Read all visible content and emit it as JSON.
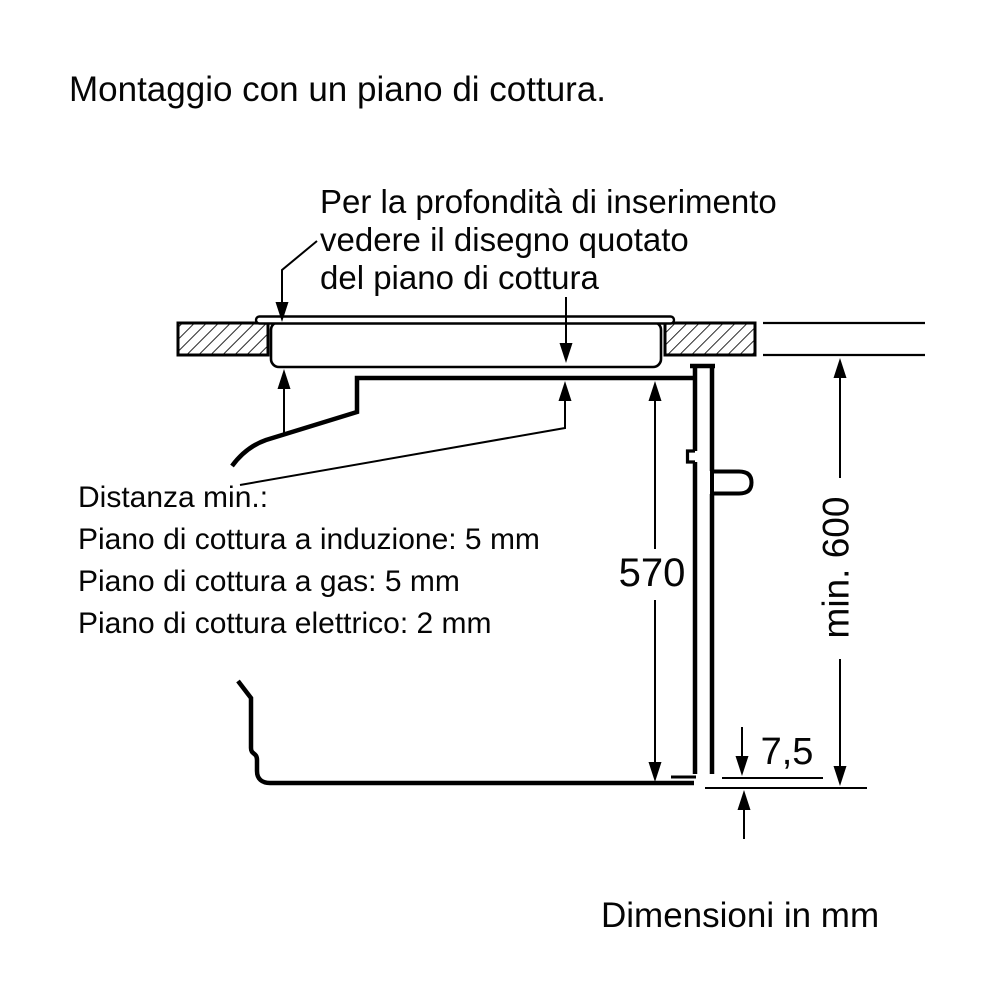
{
  "title": "Montaggio con un piano di cottura.",
  "note_insertion": {
    "lines": [
      "Per la profondità di inserimento",
      "vedere il disegno quotato",
      "del piano di cottura"
    ]
  },
  "note_distance": {
    "lines": [
      "Distanza min.:",
      "Piano di cottura a induzione: 5 mm",
      "Piano di cottura a gas: 5 mm",
      "Piano di cottura elettrico: 2 mm"
    ]
  },
  "dimensions": {
    "oven_height": "570",
    "min_niche_height": "min. 600",
    "bottom_gap": "7,5"
  },
  "footer": "Dimensioni in mm",
  "colors": {
    "line": "#000000",
    "background": "#ffffff"
  }
}
